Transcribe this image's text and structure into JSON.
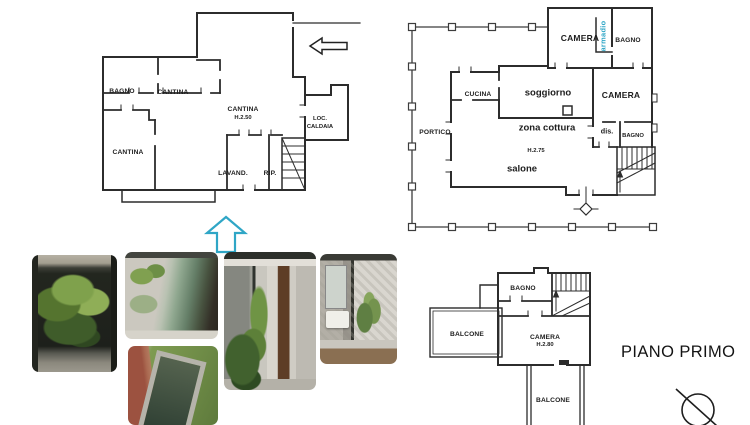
{
  "colors": {
    "accent_cyan": "#2fa6c6",
    "wall_line": "#2c2c2c",
    "background": "#ffffff"
  },
  "title": {
    "text": "PIANO PRIMO"
  },
  "plans": {
    "basement": {
      "rooms": {
        "bagno": "BAGNO",
        "cantina_top": "CANTINA",
        "cantina_main": "CANTINA",
        "cantina_main_height": "H.2.50",
        "loc_caldaia_line1": "LOC.",
        "loc_caldaia_line2": "CALDAIA",
        "cantina_left": "CANTINA",
        "lavanderia": "LAVAND.",
        "ripostiglio": "RIP."
      }
    },
    "ground": {
      "rooms": {
        "camera_top": "CAMERA",
        "armadio": "armadio",
        "bagno_top": "BAGNO",
        "cucina": "CUCINA",
        "soggiorno": "soggiorno",
        "camera_right": "CAMERA",
        "zona_cottura": "zona cottura",
        "dis": "dis.",
        "bagno_right": "BAGNO",
        "portico": "PORTICO",
        "height": "H.2.75",
        "salone": "salone"
      }
    },
    "first": {
      "rooms": {
        "bagno": "BAGNO",
        "balcone_left": "BALCONE",
        "camera": "CAMERA",
        "camera_height": "H.2.80",
        "balcone_bottom": "BALCONE"
      }
    }
  }
}
